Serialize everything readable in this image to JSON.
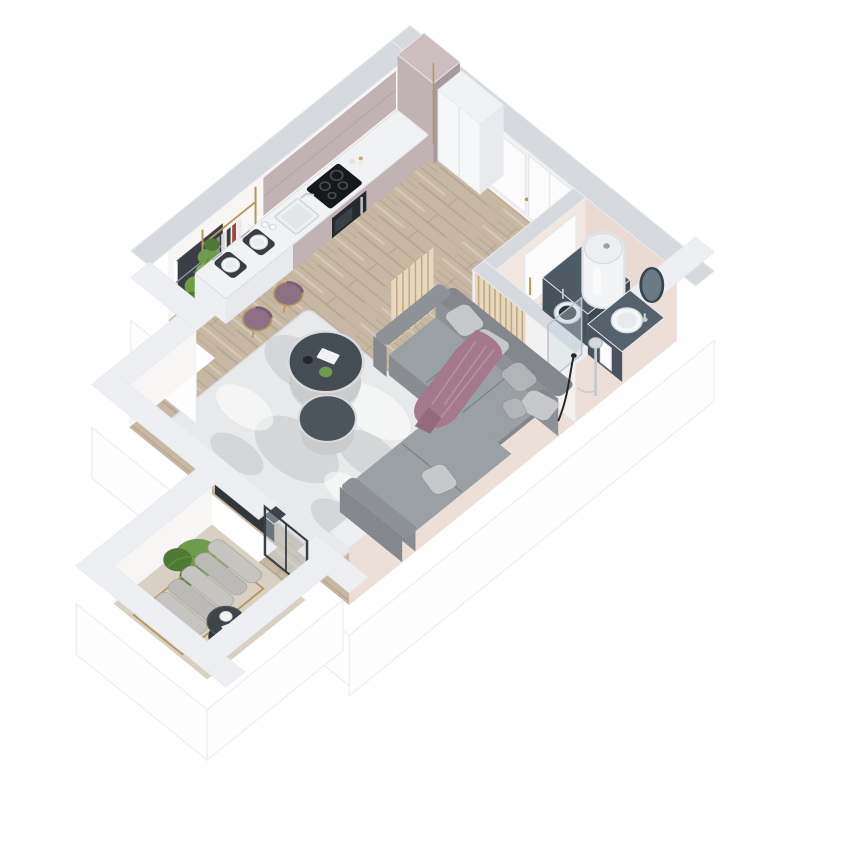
{
  "meta": {
    "type": "3d-isometric-floor-plan-render",
    "background": "#ffffff"
  },
  "palette": {
    "bg": "#ffffff",
    "wall-top-far": "#d6dade",
    "wall-top-near": "#edeff2",
    "wall-face": "#f7f6f5",
    "wall-face-2": "#f4f2f1",
    "wall-outer": "#fdfdfe",
    "wall-outer-edge": "#e9ebee",
    "bath-wall": "#e9dbd3",
    "bath-wall-light": "#f2e7e0",
    "east-wall-in": "#ecdfd8",
    "wood": "#c7b8a3",
    "wood-dark": "#a89a85",
    "wood-light": "#d8ccb9",
    "bath-floor": "#dedbd6",
    "balcony-floor": "#d7d0c3",
    "cab": "#c1b2b4",
    "cab-dark": "#a79a9e",
    "cab-light": "#ccbdbf",
    "counter": "#f0f2f4",
    "counter-edge": "#dcdfe2",
    "counter-side": "#e7e9ec",
    "cooktop": "#17181b",
    "ring": "#4a4d52",
    "oven": "#26292d",
    "steel": "#b9bcc0",
    "stool": "#8d7086",
    "stool-dark": "#7a5f74",
    "gold": "#b5975c",
    "plant": "#6f9c4c",
    "plant-dark": "#4f7a36",
    "plant-light": "#7fae5c",
    "pot": "#8a8d90",
    "rug": "#e8e9ea",
    "rug-mottle": "#a9adb2",
    "rug-edge": "#d8d9db",
    "sofa": "#9aa0a4",
    "sofa-mid": "#8e9196",
    "sofa-dark": "#84878c",
    "sofa-front": "#898c90",
    "sofa-seam": "#7c7f84",
    "pillow": "#c7c8ca",
    "pillow-2": "#b2b4b7",
    "throw": "#a3798b",
    "throw-light": "#b78f9f",
    "throw-dark": "#946a7c",
    "table-dark": "#454d54",
    "table-small": "#4d555c",
    "table-base": "#c9cbcd",
    "table-rim": "#d8dadc",
    "washer": "#46525c",
    "washer-top": "#4e5a64",
    "washer-dark": "#3d4852",
    "drum": "#2b3034",
    "vanity": "#49545e",
    "vanity-top": "#55616b",
    "chrome": "#c5cbd0",
    "glass": "rgba(203,219,229,0.38)",
    "mirror": "#6b7a85",
    "mirror-frame": "#39444c",
    "door": "#fbfbfc",
    "door-edge": "#e6e7ea",
    "frame-dark": "#3a3f45",
    "slat-bg": "#e6d8be",
    "slat-line": "#bfa87e",
    "heater": "#f3f4f6",
    "heater-top": "#eceef1",
    "heater-shadow": "#dfe1e5",
    "console": "#3f444a",
    "console-dark": "#32373c",
    "lounger-a": "#bcbab6",
    "lounger-b": "#c6c4c0",
    "lounger-edge": "#a9a7a3",
    "side-table": "#3f4449",
    "side-table-dark": "#33373a",
    "lamp": "#26282b",
    "mat": "#3a3e42",
    "plate": "#f4f5f6"
  },
  "scene": {
    "rooms": [
      {
        "id": "kitchen-dining",
        "furniture": [
          "mauve-cabinet-run",
          "white-countertop",
          "induction-cooktop",
          "built-in-oven",
          "kitchen-sink",
          "tall-cabinet",
          "white-wardrobe",
          "gold-etagere-shelf",
          "books",
          "potted-plants",
          "dining-peninsula",
          "place-settings",
          "purple-bar-stools",
          "west-window"
        ]
      },
      {
        "id": "hallway",
        "furniture": [
          "interior-door",
          "entrance-door",
          "wood-floor"
        ]
      },
      {
        "id": "bathroom",
        "furniture": [
          "washer-cabinet",
          "washing-machine",
          "water-heater",
          "vanity-unit",
          "round-basin",
          "oval-mirror",
          "towel",
          "shower-glass",
          "shower-column",
          "toiletries",
          "sliding-door"
        ]
      },
      {
        "id": "living-room",
        "furniture": [
          "l-shaped-gray-sofa",
          "cushions",
          "mauve-throw-blanket",
          "nesting-coffee-tables",
          "distressed-rug",
          "wood-slat-partition",
          "floor-lamp",
          "media-console",
          "balcony-glass-door"
        ]
      },
      {
        "id": "balcony",
        "furniture": [
          "potted-green-plant",
          "cushioned-lounger",
          "round-side-table",
          "coffee-cup"
        ]
      }
    ]
  }
}
